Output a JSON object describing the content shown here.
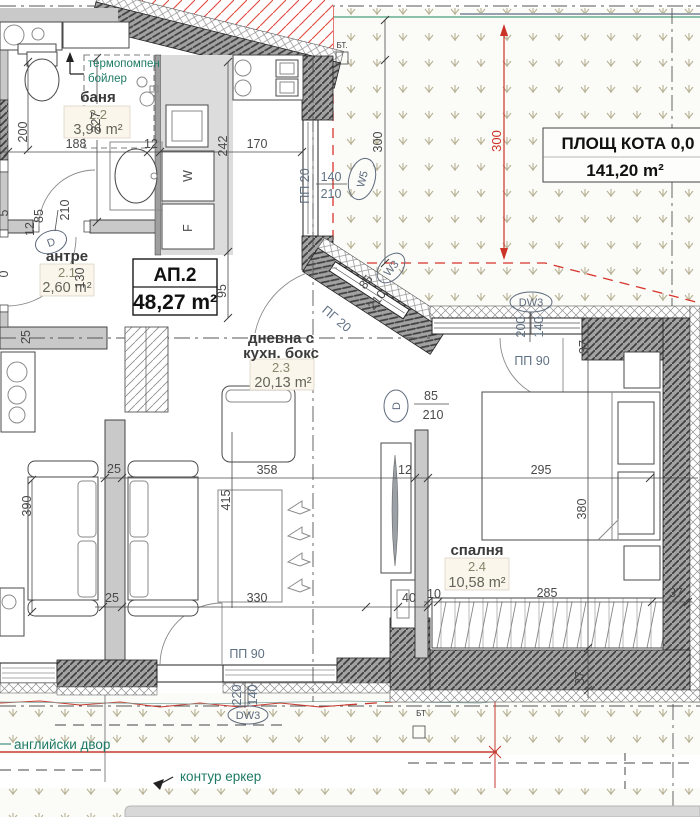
{
  "apartment": {
    "id": "АП.2",
    "area": "48,27 m²"
  },
  "site": {
    "area_title": "ПЛОЩ КОТА 0,0",
    "area_value": "141,20 m²"
  },
  "rooms": {
    "bathroom": {
      "name": "баня",
      "num": "2.2",
      "area": "3,96 m²"
    },
    "hall": {
      "name": "антре",
      "num": "2.1",
      "area": "2,60 m²"
    },
    "living": {
      "name1": "дневна с",
      "name2": "кухн. бокс",
      "num": "2.3",
      "area": "20,13 m²"
    },
    "bedroom": {
      "name": "спалня",
      "num": "2.4",
      "area": "10,58 m²"
    }
  },
  "notes": {
    "boiler1": "термопомпен",
    "boiler2": "бойлер",
    "yard": "английски двор",
    "bay": "контур еркер"
  },
  "tags": {
    "w5": "W5",
    "w3": "W3",
    "dw3a": "DW3",
    "dw3b": "DW3",
    "d1": "D",
    "d2": "D",
    "pp20": "ПП 20",
    "pp90a": "ПП 90",
    "pp90b": "ПП 90",
    "pg20": "ПГ 20",
    "bt1": "БТ.",
    "bt2": "БТ",
    "w": "W",
    "f": "F"
  },
  "dims": {
    "w200": "200",
    "w227": "227",
    "w188": "188",
    "w12": "12",
    "w170": "170",
    "w242": "242",
    "w95": "95",
    "w130": "130",
    "w25": "25",
    "h12": "12",
    "door85a": "85",
    "door210a": "210",
    "cut5": "5",
    "cut0": "0",
    "win140": "140",
    "win210": "210",
    "v300": "300",
    "r300": "300",
    "diag85": "85",
    "diag210": "210",
    "bed85": "85",
    "bed210": "210",
    "dw200": "200",
    "dw140": "140",
    "t37": "37",
    "b295": "295",
    "b380": "380",
    "tv12": "12",
    "l358": "358",
    "l415": "415",
    "l390": "390",
    "c25a": "25",
    "c25b": "25",
    "l330": "330",
    "l40": "40",
    "b10": "10",
    "b285": "285",
    "b37": "37",
    "wall37": "37",
    "dw220": "220",
    "dw140b": "140"
  },
  "colors": {
    "accent_red": "#cc3328",
    "teal": "#1e7a66",
    "grass_mark": "#b7b295"
  }
}
